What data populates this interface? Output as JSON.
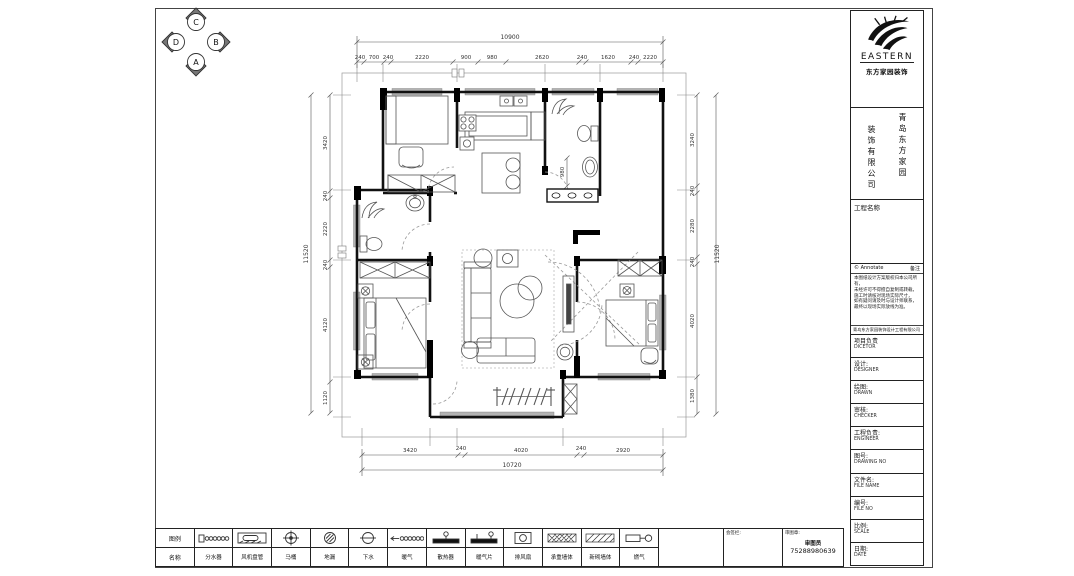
{
  "compass": {
    "top": "C",
    "right": "B",
    "bottom": "A",
    "left": "D"
  },
  "plan": {
    "dims": {
      "top_total": "10900",
      "top_segments": [
        "240",
        "700",
        "240",
        "2220",
        "900",
        "980",
        "2620",
        "240",
        "1620",
        "240",
        "2220"
      ],
      "left_total": "11520",
      "left_segments": [
        "3420",
        "240",
        "2220",
        "240",
        "4120",
        "1120"
      ],
      "right_total": "11520",
      "right_segments": [
        "3240",
        "240",
        "2280",
        "240",
        "4020",
        "1380"
      ],
      "bottom_total": "10720",
      "bottom_segments": [
        "3420",
        "240",
        "4020",
        "240",
        "2920"
      ],
      "interior_bath": "980"
    }
  },
  "title_block": {
    "logo_text": "EASTERN",
    "logo_sub": "东方家园装饰",
    "company_col_right": "青岛东方家园",
    "company_col_left": "装饰有限公司",
    "project_name_label": "工程名称",
    "notes_header_left": "© Annotate",
    "notes_header_right": "备注",
    "notes_lines": [
      "本图纸设计方案版权归本公司所有，",
      "未经许可不得擅自复制或转载，",
      "施工时请核对现场实际尺寸，",
      "如有疑问请及时与设计师联系，",
      "最终以现场实际放线为准。"
    ],
    "notes_footer": "青岛东方家园装饰设计工程有限公司",
    "rows": [
      {
        "zh": "项目负责",
        "en": "DICETOR"
      },
      {
        "zh": "设计:",
        "en": "DESIGNER"
      },
      {
        "zh": "绘图:",
        "en": "DRAWN"
      },
      {
        "zh": "审核:",
        "en": "CHECKER"
      },
      {
        "zh": "工程负责:",
        "en": "ENGINEER"
      },
      {
        "zh": "图号:",
        "en": "DRAWING NO"
      },
      {
        "zh": "文件名:",
        "en": "FILE NAME"
      },
      {
        "zh": "编号:",
        "en": "FILE NO"
      },
      {
        "zh": "比例:",
        "en": "SCALE"
      },
      {
        "zh": "日期:",
        "en": "DATE"
      }
    ]
  },
  "legend": {
    "header_top": "图例",
    "header_bottom": "名称",
    "items": [
      {
        "label": "分水器"
      },
      {
        "label": "风机盘管"
      },
      {
        "label": "马桶"
      },
      {
        "label": "地漏"
      },
      {
        "label": "下水"
      },
      {
        "label": "暖气"
      },
      {
        "label": "散热器"
      },
      {
        "label": "暖气片"
      },
      {
        "label": "排风扇"
      },
      {
        "label": "承重墙体"
      },
      {
        "label": "新砌墙体"
      },
      {
        "label": "燃气"
      }
    ],
    "sign_cell_label": "会签栏:",
    "review_cell_label": "审图章:",
    "reviewer": "审图员",
    "phone": "75288980639"
  }
}
